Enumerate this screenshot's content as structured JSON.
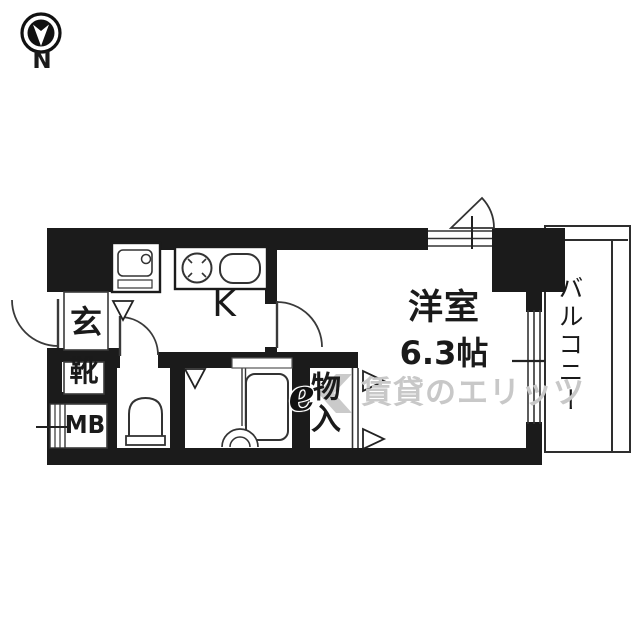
{
  "compass": {
    "label": "N"
  },
  "rooms": {
    "entrance": {
      "label": "玄"
    },
    "shoe_box": {
      "label": "靴"
    },
    "meter_box": {
      "label": "MB"
    },
    "kitchen": {
      "label": "K"
    },
    "western_room": {
      "label": "洋室",
      "size": "6.3帖"
    },
    "storage": {
      "label": "物入"
    },
    "balcony": {
      "label": "バルコニー"
    }
  },
  "watermark": {
    "logo_text": "e",
    "text": "賃貸のエリッツ"
  },
  "colors": {
    "wall": "#1b1b1b",
    "background": "#ffffff",
    "fixture_line": "#333333",
    "watermark_gray": "#c8c8c8"
  }
}
